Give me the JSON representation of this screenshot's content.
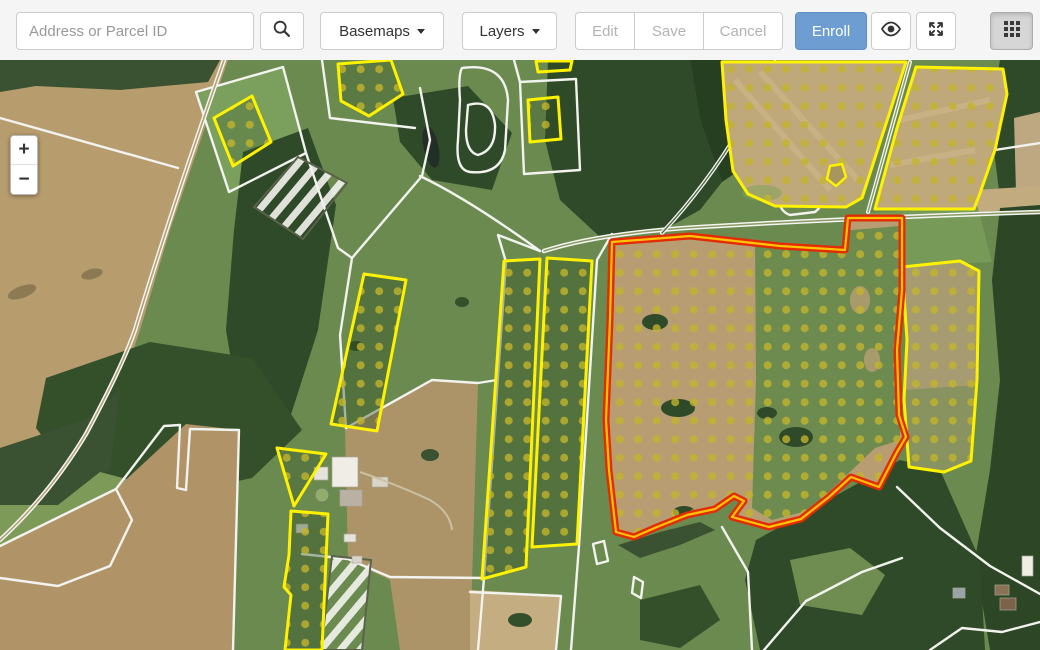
{
  "toolbar": {
    "search_placeholder": "Address or Parcel ID",
    "basemaps_label": "Basemaps",
    "layers_label": "Layers",
    "edit_label": "Edit",
    "save_label": "Save",
    "cancel_label": "Cancel",
    "enroll_label": "Enroll"
  },
  "map_controls": {
    "zoom_in_label": "+",
    "zoom_out_label": "−"
  },
  "colors": {
    "toolbar_bg": "#f5f5f5",
    "enroll_button_bg": "#6d9dd1",
    "enrolled_parcel_outline": "#fff200",
    "selected_parcel_outline": "#e22c00",
    "selected_parcel_inner_line": "#ffc400",
    "enrollment_dot": "#c3b52c",
    "parcel_boundary_line": "#f2f2ef"
  },
  "icons": {
    "search": "magnifier",
    "basemaps_dropdown": "caret-down",
    "layers_dropdown": "caret-down",
    "visibility": "eye",
    "fullscreen": "expand-arrows",
    "apps": "grid-3x3"
  }
}
